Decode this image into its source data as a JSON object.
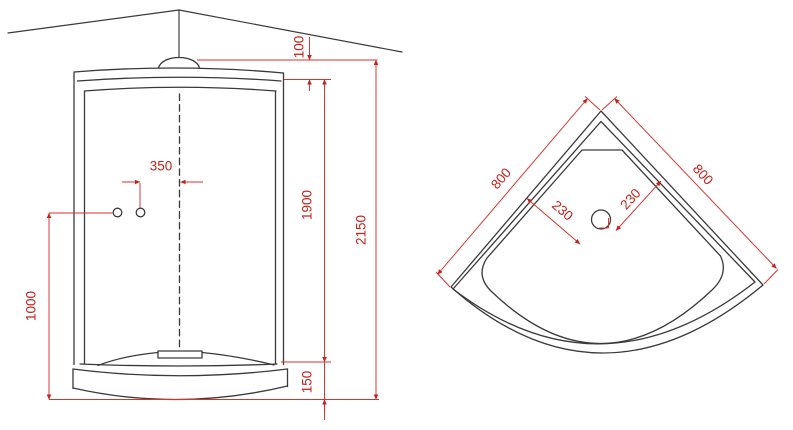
{
  "diagram": {
    "front_view": {
      "dimensions": {
        "dome_offset": "100",
        "handle_to_center": "350",
        "door_height": "1900",
        "total_height": "2150",
        "handle_height": "1000",
        "tray_height": "150"
      }
    },
    "plan_view": {
      "dimensions": {
        "left_side": "800",
        "right_side": "800",
        "drain_offset_left": "230",
        "drain_offset_right": "230"
      }
    },
    "colors": {
      "outline": "#3a3a3a",
      "dimension_line": "#d9302a",
      "dimension_text": "#c4211c"
    }
  }
}
